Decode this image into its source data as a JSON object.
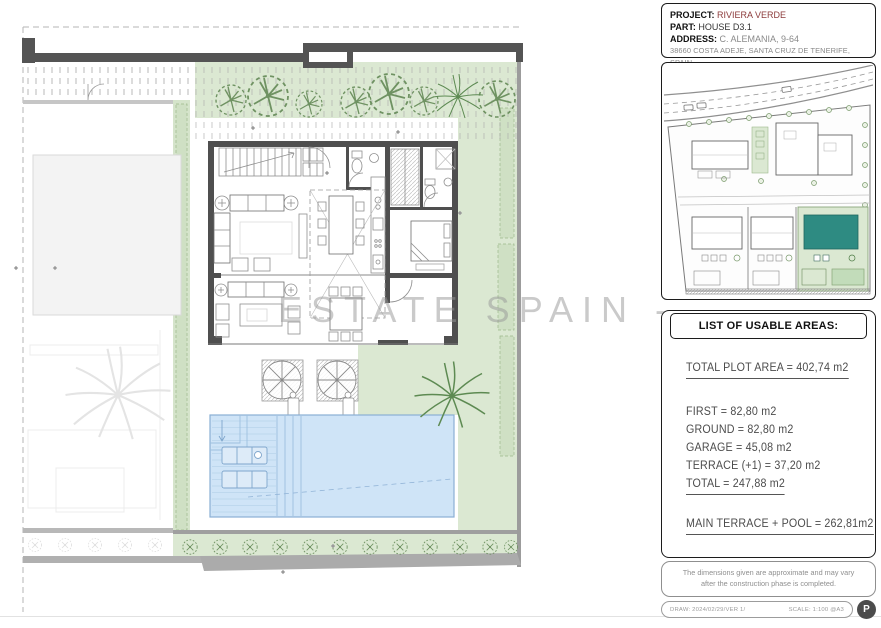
{
  "header": {
    "project_label": "PROJECT:",
    "project_value": "RIVIERA VERDE",
    "part_label": "PART:",
    "part_value": "HOUSE D3.1",
    "address_label": "ADDRESS:",
    "address_value": "C. ALEMANIA, 9-64",
    "address_line2": "38660 COSTA ADEJE, SANTA CRUZ DE TENERIFE, SPAIN"
  },
  "watermark": "ESTATE SPAIN -",
  "areas": {
    "title": "LIST OF USABLE AREAS:",
    "total_plot": "TOTAL PLOT AREA = 402,74 m2",
    "rows": [
      "FIRST = 82,80 m2",
      "GROUND = 82,80 m2",
      "GARAGE = 45,08 m2",
      "TERRACE (+1) = 37,20 m2"
    ],
    "total": "TOTAL = 247,88 m2",
    "main_terrace_pool": "MAIN TERRACE + POOL = 262,81m2"
  },
  "disclaimer": "The dimensions given are approximate and may vary after the construction phase is completed.",
  "footer": {
    "draw": "DRAW: 2024/02/29/VER 1/",
    "scale": "SCALE: 1:100 @A3",
    "logo_letter": "P"
  },
  "colors": {
    "accent_red": "#8c3b3b",
    "garden_green": "#dbe8d2",
    "pool_blue": "#cfe4f7",
    "highlight_teal": "#2e8b82",
    "wall_gray": "#545454"
  }
}
